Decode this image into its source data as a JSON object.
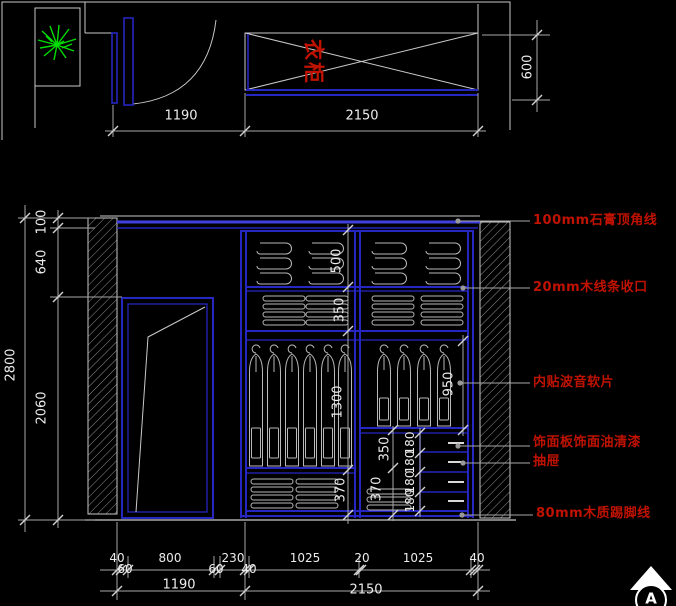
{
  "colors": {
    "background": "#000000",
    "line": "#c9c9c9",
    "blue": "#2626c0",
    "blue_bright": "#4040e0",
    "red": "#c01200",
    "green": "#00dd00",
    "dim_text": "#ececec"
  },
  "plan": {
    "wardrobe_label": "衣柜",
    "dim_door": "1190",
    "dim_wardrobe": "2150",
    "dim_depth": "600"
  },
  "elev": {
    "dim_total": "2800",
    "dim_crown": "100",
    "dim_header": "640",
    "dim_opening": "2060",
    "dim_shelf_top": "500",
    "dim_shelf_mid": "350",
    "dim_hang_left": "1300",
    "dim_hang_right": "950",
    "dim_right_mid": "350",
    "dim_bottom_left": "370",
    "dim_bottom_mid": "370",
    "drawer_dims": [
      "180",
      "180",
      "180",
      "180"
    ],
    "annotations": [
      "100mm石膏顶角线",
      "20mm木线条收口",
      "内贴波音软片",
      "饰面板饰面油清漆",
      "抽屉",
      "80mm木质踢脚线"
    ]
  },
  "bottom": {
    "row1": [
      "40",
      "60",
      "800",
      "60",
      "230",
      "40",
      "1025",
      "20",
      "1025",
      "40"
    ],
    "row2_left": "1190",
    "row2_right": "2150"
  },
  "marker": "A"
}
